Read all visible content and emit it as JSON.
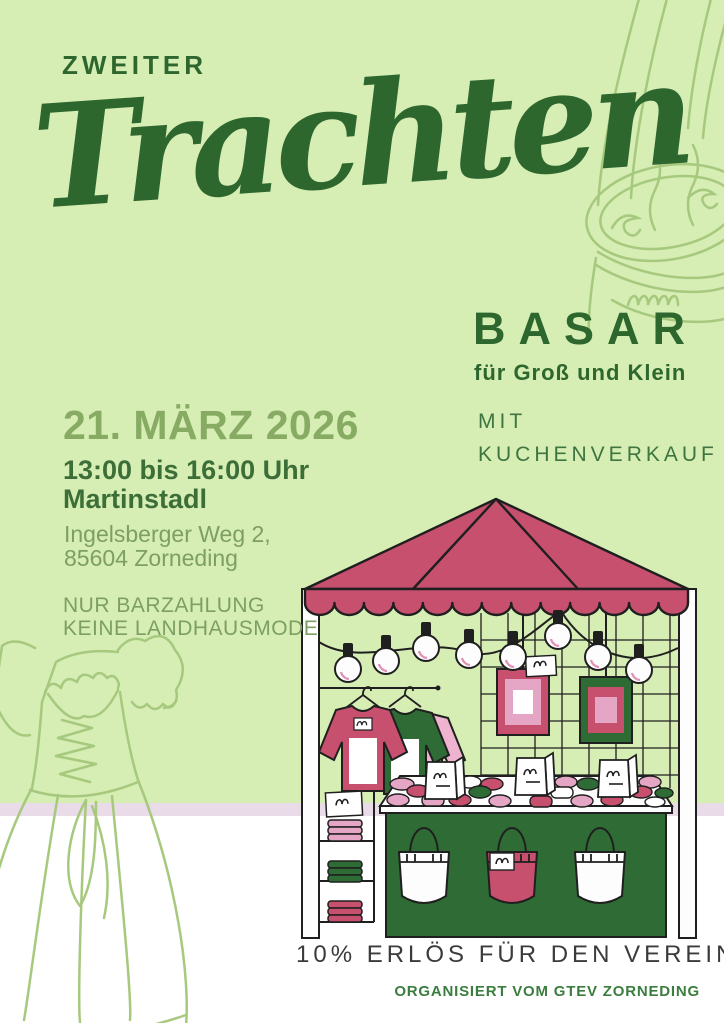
{
  "poster": {
    "kicker": "ZWEITER",
    "title_script": "Trachten",
    "title_caps": "BASAR",
    "tagline": "für Groß und Klein",
    "side_note": {
      "line1": "MIT",
      "line2": "KUCHENVERKAUF"
    },
    "event": {
      "date": "21. MÄRZ 2026",
      "time": "13:00 bis 16:00 Uhr",
      "venue": "Martinstadl",
      "address1": "Ingelsberger Weg 2,",
      "address2": "85604 Zorneding",
      "notice1": "NUR BARZAHLUNG",
      "notice2": "KEINE LANDHAUSMODE"
    },
    "footer": {
      "main": "10% ERLÖS FÜR DEN VEREIN",
      "organizer": "ORGANISIERT VOM GTEV ZORNEDING"
    },
    "colors": {
      "background_green": "#d6edb4",
      "dark_green": "#2d672e",
      "medium_green": "#87ab63",
      "body_green": "#7d9f63",
      "accent_green": "#3e7540",
      "organizer_green": "#3a7d3e",
      "raspberry": "#c7506f",
      "light_pink": "#e5a5c5",
      "stall_green": "#2f6b35",
      "pale_pink_strip": "#e9dce8",
      "footer_text": "#3b3b3b",
      "outline_green": "#a6c97e"
    },
    "illustrations": {
      "main": "market-stall-with-string-lights-clothes-frames-and-tote-bags",
      "top_right": "lederhosen-outline",
      "bottom_left": "dirndl-dress-outline"
    }
  }
}
